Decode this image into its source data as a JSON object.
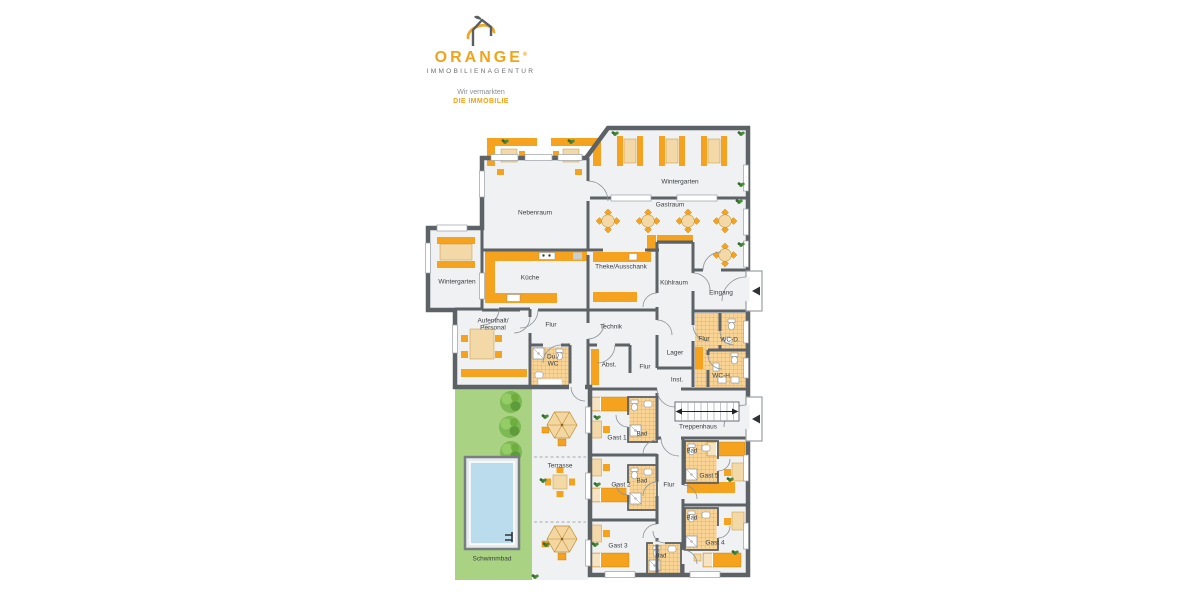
{
  "logo": {
    "brand": "ORANGE",
    "registered": "®",
    "subtitle": "IMMOBILIENAGENTUR",
    "tagline_line1": "Wir vermarkten",
    "tagline_line2": "DIE IMMOBILIE"
  },
  "rooms": {
    "wintergarten_top": "Wintergarten",
    "gastraum": "Gastraum",
    "nebenraum": "Nebenraum",
    "wintergarten_left": "Wintergarten",
    "kueche": "Küche",
    "theke": "Theke/Ausschank",
    "kuehlraum": "Kühlraum",
    "eingang": "Eingang",
    "aufenthalt": "Aufenthalt/\nPersonal",
    "flur_main": "Flur",
    "technik": "Technik",
    "du_wc": "Du./\nWC",
    "abstellraum": "Abst.",
    "flur_mitte": "Flur",
    "lager": "Lager",
    "flur_wc": "Flur",
    "wc_damen": "WC-D.",
    "wc_herren": "WC-H.",
    "installation": "Inst.",
    "treppenhaus": "Treppenhaus",
    "gast1": "Gast 1",
    "gast2": "Gast 2",
    "gast3": "Gast 3",
    "gast4": "Gast 4",
    "gast5": "Gast 5",
    "bad1": "Bad",
    "bad2": "Bad",
    "bad3": "Bad",
    "bad4": "Bad",
    "bad5": "Bad",
    "flur_gast": "Flur",
    "terrasse": "Terrasse",
    "schwimmbad": "Schwimmbad"
  },
  "colors": {
    "wall": "#5D6267",
    "floor": "#EFF1F2",
    "furniture_orange": "#F5A21E",
    "furniture_beige": "#F3D9A8",
    "tile_bg": "#F9D494",
    "tile_line": "#E8A945",
    "garden_green": "#A9D383",
    "tree_green": "#71B044",
    "pool_blue": "#BBDCEC",
    "brand_orange": "#F2A316",
    "brand_gray": "#6B6F73"
  }
}
